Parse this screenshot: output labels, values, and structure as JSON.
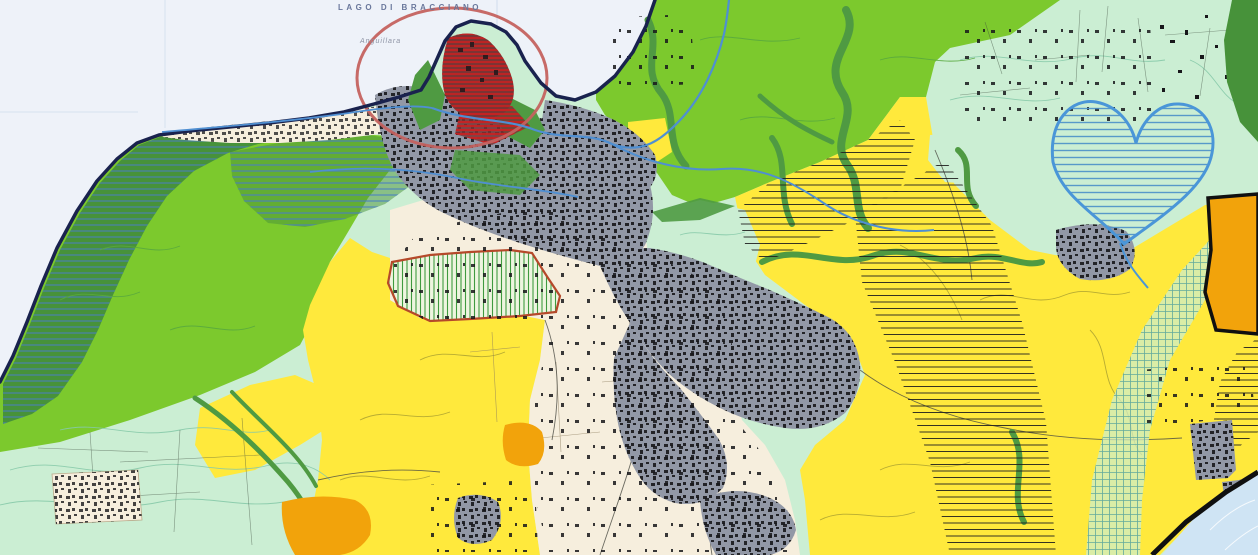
{
  "labels": {
    "lake": "LAGO DI BRACCIANO",
    "town": "Anguillara"
  },
  "colors": {
    "water": "#eef2f9",
    "waterGrid": "#c8d6ea",
    "martignano": "#cfe4f4",
    "coastline": "#19224e",
    "greenBright": "#7cc92d",
    "greenMid": "#4f9a42",
    "greenForest": "#47923a",
    "mint": "#cbeed3",
    "yellow": "#ffe93c",
    "cream": "#f6eedd",
    "creamLine": "#b9a98a",
    "urbanGray": "#9298a6",
    "building": "#17171a",
    "hatchBlue": "#4a7fc0",
    "hatchBlack": "#1f1f1f",
    "heartOutline": "#4a96d8",
    "heartHatch": "#4a8fc8",
    "redZone": "#7c3434",
    "redHatch": "#cf1f1f",
    "circleOutline": "#c4625f",
    "redBoundary": "#b5492a",
    "greenHatchFill": "#eef5e0",
    "greenHatchLine": "#3f9a3f",
    "orange": "#f2a30b",
    "road": "#4f8fd2",
    "boundaryBlack": "#101010",
    "gridMint": "#55a39b"
  }
}
